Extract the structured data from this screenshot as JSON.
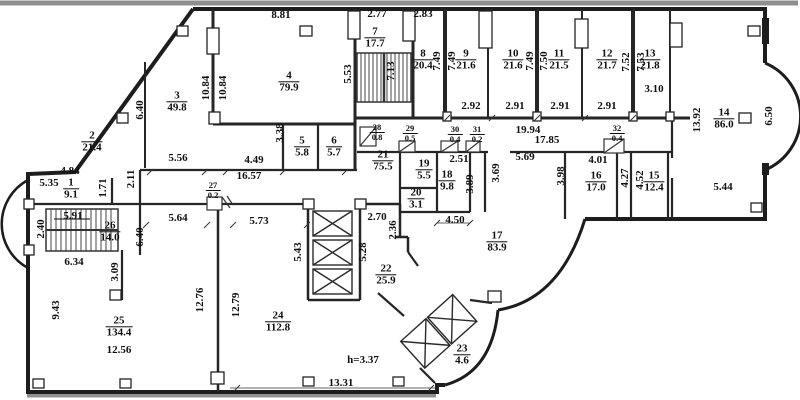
{
  "drawing": {
    "kind": "architectural floor plan",
    "height_note": "h=3.37",
    "wall_color": "#1d1d1d",
    "secondary_wall_color": "#8f8f8f",
    "text_color": "#101010"
  },
  "rooms": [
    {
      "number": "1",
      "area": "9.1",
      "x": 71,
      "y": 189
    },
    {
      "number": "2",
      "area": "21.4",
      "x": 92,
      "y": 142
    },
    {
      "number": "3",
      "area": "49.8",
      "x": 177,
      "y": 102
    },
    {
      "number": "4",
      "area": "79.9",
      "x": 289,
      "y": 82
    },
    {
      "number": "5",
      "area": "5.8",
      "x": 302,
      "y": 147
    },
    {
      "number": "6",
      "area": "5.7",
      "x": 334,
      "y": 147
    },
    {
      "number": "7",
      "area": "17.7",
      "x": 375,
      "y": 38
    },
    {
      "number": "8",
      "area": "20.4",
      "x": 423,
      "y": 60
    },
    {
      "number": "9",
      "area": "21.6",
      "x": 466,
      "y": 60
    },
    {
      "number": "10",
      "area": "21.6",
      "x": 513,
      "y": 60
    },
    {
      "number": "11",
      "area": "21.5",
      "x": 559,
      "y": 60
    },
    {
      "number": "12",
      "area": "21.7",
      "x": 607,
      "y": 60
    },
    {
      "number": "13",
      "area": "21.8",
      "x": 650,
      "y": 60
    },
    {
      "number": "14",
      "area": "86.0",
      "x": 724,
      "y": 119
    },
    {
      "number": "15",
      "area": "12.4",
      "x": 654,
      "y": 182
    },
    {
      "number": "16",
      "area": "17.0",
      "x": 596,
      "y": 182
    },
    {
      "number": "17",
      "area": "83.9",
      "x": 497,
      "y": 242
    },
    {
      "number": "18",
      "area": "9.8",
      "x": 447,
      "y": 181
    },
    {
      "number": "19",
      "area": "5.5",
      "x": 424,
      "y": 170
    },
    {
      "number": "20",
      "area": "3.1",
      "x": 416,
      "y": 199
    },
    {
      "number": "21",
      "area": "75.5",
      "x": 383,
      "y": 161
    },
    {
      "number": "22",
      "area": "25.9",
      "x": 386,
      "y": 275
    },
    {
      "number": "23",
      "area": "4.6",
      "x": 462,
      "y": 355
    },
    {
      "number": "24",
      "area": "112.8",
      "x": 278,
      "y": 322
    },
    {
      "number": "25",
      "area": "134.4",
      "x": 119,
      "y": 327
    },
    {
      "number": "26",
      "area": "14.0",
      "x": 110,
      "y": 232
    },
    {
      "number": "27",
      "area": "0.2",
      "x": 213,
      "y": 190,
      "small": true
    },
    {
      "number": "28",
      "area": "0.8",
      "x": 377,
      "y": 132,
      "small": true
    },
    {
      "number": "29",
      "area": "0.5",
      "x": 410,
      "y": 133,
      "small": true
    },
    {
      "number": "30",
      "area": "0.4",
      "x": 455,
      "y": 134,
      "small": true
    },
    {
      "number": "31",
      "area": "0.2",
      "x": 477,
      "y": 134,
      "small": true
    },
    {
      "number": "32",
      "area": "0.4",
      "x": 617,
      "y": 133,
      "small": true
    }
  ],
  "dimensions": [
    {
      "text": "8.81",
      "x": 281,
      "y": 15
    },
    {
      "text": "2.77",
      "x": 377,
      "y": 14
    },
    {
      "text": "2.83",
      "x": 423,
      "y": 14
    },
    {
      "text": "10.84",
      "x": 206,
      "y": 88,
      "v": true
    },
    {
      "text": "10.84",
      "x": 223,
      "y": 88,
      "v": true
    },
    {
      "text": "6.40",
      "x": 140,
      "y": 110,
      "v": true
    },
    {
      "text": "5.53",
      "x": 348,
      "y": 74,
      "v": true
    },
    {
      "text": "7.13",
      "x": 391,
      "y": 71,
      "v": true
    },
    {
      "text": "7.49",
      "x": 437,
      "y": 61,
      "v": true
    },
    {
      "text": "7.49",
      "x": 452,
      "y": 61,
      "v": true
    },
    {
      "text": "7.49",
      "x": 530,
      "y": 61,
      "v": true
    },
    {
      "text": "7.50",
      "x": 544,
      "y": 61,
      "v": true
    },
    {
      "text": "7.52",
      "x": 626,
      "y": 62,
      "v": true
    },
    {
      "text": "7.53",
      "x": 641,
      "y": 62,
      "v": true
    },
    {
      "text": "2.92",
      "x": 471,
      "y": 106
    },
    {
      "text": "2.91",
      "x": 515,
      "y": 106
    },
    {
      "text": "2.91",
      "x": 560,
      "y": 106
    },
    {
      "text": "2.91",
      "x": 607,
      "y": 106
    },
    {
      "text": "3.10",
      "x": 654,
      "y": 89
    },
    {
      "text": "13.92",
      "x": 697,
      "y": 120,
      "v": true
    },
    {
      "text": "6.50",
      "x": 769,
      "y": 116,
      "v": true
    },
    {
      "text": "3.38",
      "x": 280,
      "y": 133,
      "v": true
    },
    {
      "text": "19.94",
      "x": 528,
      "y": 130
    },
    {
      "text": "17.85",
      "x": 547,
      "y": 140
    },
    {
      "text": "2.51",
      "x": 459,
      "y": 159
    },
    {
      "text": "5.69",
      "x": 525,
      "y": 157
    },
    {
      "text": "3.69",
      "x": 496,
      "y": 173,
      "v": true
    },
    {
      "text": "3.98",
      "x": 561,
      "y": 176,
      "v": true
    },
    {
      "text": "3.89",
      "x": 470,
      "y": 184,
      "v": true
    },
    {
      "text": "4.01",
      "x": 598,
      "y": 160
    },
    {
      "text": "4.27",
      "x": 625,
      "y": 178,
      "v": true
    },
    {
      "text": "4.52",
      "x": 640,
      "y": 180,
      "v": true
    },
    {
      "text": "5.44",
      "x": 723,
      "y": 187
    },
    {
      "text": "5.56",
      "x": 178,
      "y": 158
    },
    {
      "text": "4.49",
      "x": 254,
      "y": 160
    },
    {
      "text": "16.57",
      "x": 249,
      "y": 176
    },
    {
      "text": "4.84",
      "x": 70,
      "y": 171
    },
    {
      "text": "5.35",
      "x": 49,
      "y": 183
    },
    {
      "text": "1.71",
      "x": 103,
      "y": 188,
      "v": true
    },
    {
      "text": "2.11",
      "x": 131,
      "y": 179,
      "v": true
    },
    {
      "text": "5.91",
      "x": 73,
      "y": 216
    },
    {
      "text": "2.40",
      "x": 41,
      "y": 229,
      "v": true
    },
    {
      "text": "6.34",
      "x": 74,
      "y": 262
    },
    {
      "text": "3.09",
      "x": 115,
      "y": 272,
      "v": true
    },
    {
      "text": "6.40",
      "x": 140,
      "y": 237,
      "v": true
    },
    {
      "text": "5.64",
      "x": 178,
      "y": 218
    },
    {
      "text": "5.73",
      "x": 259,
      "y": 221
    },
    {
      "text": "2.70",
      "x": 377,
      "y": 217
    },
    {
      "text": "2.36",
      "x": 393,
      "y": 230,
      "v": true
    },
    {
      "text": "5.43",
      "x": 298,
      "y": 252,
      "v": true
    },
    {
      "text": "5.28",
      "x": 363,
      "y": 252,
      "v": true
    },
    {
      "text": "4.50",
      "x": 455,
      "y": 220
    },
    {
      "text": "12.76",
      "x": 200,
      "y": 300,
      "v": true
    },
    {
      "text": "12.79",
      "x": 236,
      "y": 305,
      "v": true
    },
    {
      "text": "9.43",
      "x": 56,
      "y": 310,
      "v": true
    },
    {
      "text": "12.56",
      "x": 119,
      "y": 350
    },
    {
      "text": "h=3.37",
      "x": 363,
      "y": 360
    },
    {
      "text": "13.31",
      "x": 341,
      "y": 383
    }
  ]
}
